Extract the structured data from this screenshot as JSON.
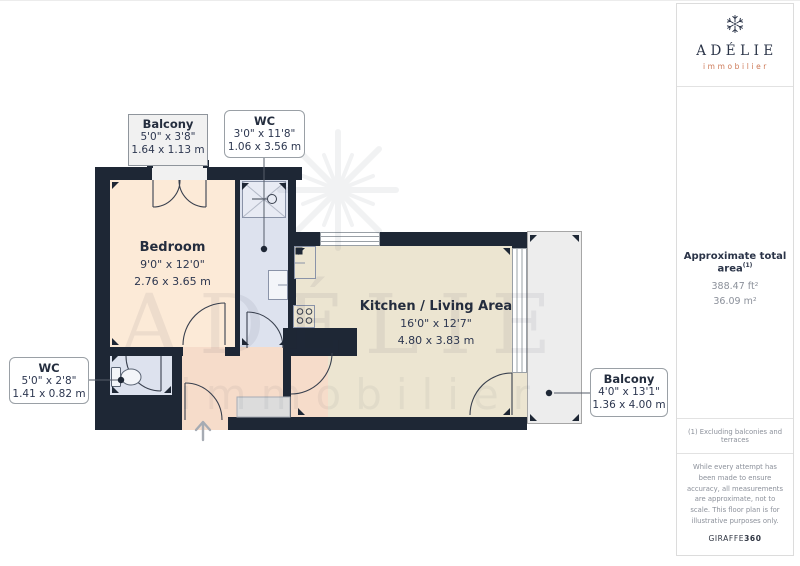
{
  "brand": {
    "name": "ADÉLIE",
    "tagline": "immobilier"
  },
  "watermark": {
    "name": "ADÉLIE",
    "tagline": "immobilier"
  },
  "rooms": {
    "bedroom": {
      "name": "Bedroom",
      "imperial": "9'0\" x 12'0\"",
      "metric": "2.76 x 3.65 m"
    },
    "kitchen": {
      "name": "Kitchen / Living Area",
      "imperial": "16'0\" x 12'7\"",
      "metric": "4.80 x 3.83 m"
    },
    "balcony_top": {
      "name": "Balcony",
      "imperial": "5'0\" x 3'8\"",
      "metric": "1.64 x 1.13 m"
    },
    "wc_top": {
      "name": "WC",
      "imperial": "3'0\" x 11'8\"",
      "metric": "1.06 x 3.56 m"
    },
    "wc_left": {
      "name": "WC",
      "imperial": "5'0\" x 2'8\"",
      "metric": "1.41 x 0.82 m"
    },
    "balcony_right": {
      "name": "Balcony",
      "imperial": "4'0\" x 13'1\"",
      "metric": "1.36 x 4.00 m"
    }
  },
  "sidebar": {
    "area_title": "Approximate total area",
    "area_footnote_marker": "(1)",
    "area_imperial": "388.47 ft²",
    "area_metric": "36.09 m²",
    "footnote": "(1) Excluding balconies and terraces",
    "disclaimer": "While every attempt has been made to ensure accuracy, all measurements are approximate, not to scale. This floor plan is for illustrative purposes only.",
    "credit_brand": "GIRAFFE",
    "credit_bold": "360"
  },
  "colors": {
    "wall": "#1e2735",
    "bedroom": "#fcead7",
    "kitchen": "#ece5d1",
    "hallway": "#f6dcca",
    "wc": "#dde2ee",
    "balcony": "#ededed",
    "accent": "#cd7a58",
    "navy": "#2b3448"
  }
}
